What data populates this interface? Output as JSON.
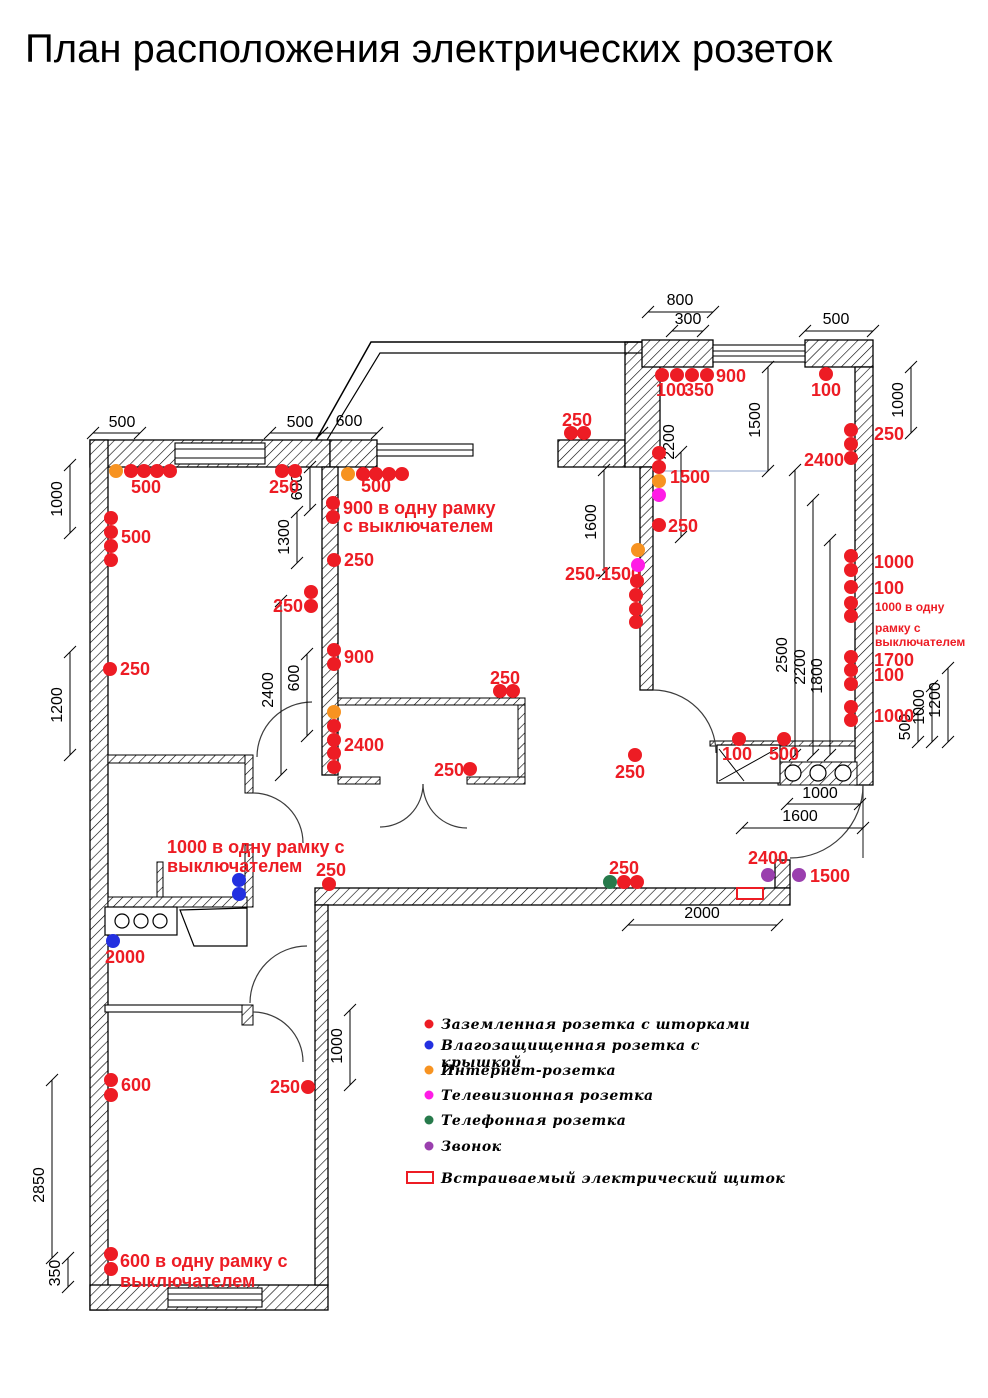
{
  "title": "План расположения электрических розеток",
  "colors": {
    "r": "#ed1c24",
    "b": "#2330e0",
    "o": "#f79321",
    "m": "#ff1ce6",
    "g": "#277a4b",
    "p": "#9a3fae",
    "label": "#ed1c24",
    "dim": "#000000",
    "panel_outline": "#ed1c24"
  },
  "type_names": {
    "r": "grounded-socket",
    "b": "moisture-protected-socket",
    "o": "internet-socket",
    "m": "tv-socket",
    "g": "phone-socket",
    "p": "doorbell"
  },
  "outlets": [
    [
      116,
      471,
      "o"
    ],
    [
      131,
      471,
      "r"
    ],
    [
      144,
      471,
      "r"
    ],
    [
      157,
      471,
      "r"
    ],
    [
      170,
      471,
      "r"
    ],
    [
      111,
      518,
      "r"
    ],
    [
      111,
      532,
      "r"
    ],
    [
      111,
      546,
      "r"
    ],
    [
      111,
      560,
      "r"
    ],
    [
      110,
      669,
      "r"
    ],
    [
      282,
      471,
      "r"
    ],
    [
      295,
      471,
      "r"
    ],
    [
      311,
      592,
      "r"
    ],
    [
      311,
      606,
      "r"
    ],
    [
      334,
      650,
      "r"
    ],
    [
      334,
      664,
      "r"
    ],
    [
      334,
      712,
      "o"
    ],
    [
      334,
      726,
      "r"
    ],
    [
      334,
      740,
      "r"
    ],
    [
      334,
      753,
      "r"
    ],
    [
      334,
      767,
      "r"
    ],
    [
      348,
      474,
      "o"
    ],
    [
      363,
      474,
      "r"
    ],
    [
      376,
      474,
      "r"
    ],
    [
      389,
      474,
      "r"
    ],
    [
      402,
      474,
      "r"
    ],
    [
      333,
      503,
      "r"
    ],
    [
      333,
      517,
      "r"
    ],
    [
      334,
      560,
      "r"
    ],
    [
      571,
      433,
      "r"
    ],
    [
      584,
      433,
      "r"
    ],
    [
      638,
      550,
      "o"
    ],
    [
      638,
      565,
      "m"
    ],
    [
      637,
      581,
      "r"
    ],
    [
      636,
      595,
      "r"
    ],
    [
      636,
      609,
      "r"
    ],
    [
      636,
      622,
      "r"
    ],
    [
      659,
      453,
      "r"
    ],
    [
      659,
      467,
      "r"
    ],
    [
      659,
      481,
      "o"
    ],
    [
      659,
      495,
      "m"
    ],
    [
      659,
      525,
      "r"
    ],
    [
      662,
      375,
      "r"
    ],
    [
      677,
      375,
      "r"
    ],
    [
      692,
      375,
      "r"
    ],
    [
      707,
      375,
      "r"
    ],
    [
      826,
      374,
      "r"
    ],
    [
      851,
      430,
      "r"
    ],
    [
      851,
      444,
      "r"
    ],
    [
      851,
      458,
      "r"
    ],
    [
      851,
      556,
      "r"
    ],
    [
      851,
      570,
      "r"
    ],
    [
      851,
      587,
      "r"
    ],
    [
      851,
      603,
      "r"
    ],
    [
      851,
      616,
      "r"
    ],
    [
      851,
      657,
      "r"
    ],
    [
      851,
      670,
      "r"
    ],
    [
      851,
      684,
      "r"
    ],
    [
      851,
      707,
      "r"
    ],
    [
      851,
      720,
      "r"
    ],
    [
      739,
      739,
      "r"
    ],
    [
      784,
      739,
      "r"
    ],
    [
      635,
      755,
      "r"
    ],
    [
      329,
      884,
      "r"
    ],
    [
      610,
      882,
      "g"
    ],
    [
      624,
      882,
      "r"
    ],
    [
      637,
      882,
      "r"
    ],
    [
      768,
      875,
      "p"
    ],
    [
      799,
      875,
      "p"
    ],
    [
      500,
      691,
      "r"
    ],
    [
      513,
      691,
      "r"
    ],
    [
      470,
      769,
      "r"
    ],
    [
      239,
      880,
      "b"
    ],
    [
      239,
      894,
      "b"
    ],
    [
      113,
      941,
      "b"
    ],
    [
      111,
      1080,
      "r"
    ],
    [
      111,
      1095,
      "r"
    ],
    [
      308,
      1087,
      "r"
    ],
    [
      111,
      1254,
      "r"
    ],
    [
      111,
      1269,
      "r"
    ]
  ],
  "plan_labels": [
    {
      "t": "500",
      "x": 146,
      "y": 493,
      "a": "middle"
    },
    {
      "t": "500",
      "x": 121,
      "y": 543,
      "a": "start"
    },
    {
      "t": "250",
      "x": 120,
      "y": 675,
      "a": "start"
    },
    {
      "t": "250",
      "x": 284,
      "y": 493,
      "a": "middle"
    },
    {
      "t": "250",
      "x": 303,
      "y": 612,
      "a": "end"
    },
    {
      "t": "900",
      "x": 344,
      "y": 663,
      "a": "start"
    },
    {
      "t": "2400",
      "x": 344,
      "y": 751,
      "a": "start"
    },
    {
      "t": "500",
      "x": 376,
      "y": 492,
      "a": "middle"
    },
    {
      "t": "900 в одну рамку",
      "x": 343,
      "y": 514,
      "a": "start"
    },
    {
      "t": "с выключателем",
      "x": 343,
      "y": 532,
      "a": "start"
    },
    {
      "t": "250",
      "x": 344,
      "y": 566,
      "a": "start"
    },
    {
      "t": "250",
      "x": 577,
      "y": 426,
      "a": "middle"
    },
    {
      "t": "250-1500",
      "x": 565,
      "y": 580,
      "a": "start"
    },
    {
      "t": "1500",
      "x": 670,
      "y": 483,
      "a": "start"
    },
    {
      "t": "250",
      "x": 668,
      "y": 532,
      "a": "start"
    },
    {
      "t": "900",
      "x": 716,
      "y": 382,
      "a": "start"
    },
    {
      "t": "100",
      "x": 656,
      "y": 396,
      "a": "start"
    },
    {
      "t": "350",
      "x": 684,
      "y": 396,
      "a": "start"
    },
    {
      "t": "100",
      "x": 826,
      "y": 396,
      "a": "middle"
    },
    {
      "t": "250",
      "x": 874,
      "y": 440,
      "a": "start"
    },
    {
      "t": "2400",
      "x": 844,
      "y": 466,
      "a": "end"
    },
    {
      "t": "1000",
      "x": 874,
      "y": 568,
      "a": "start"
    },
    {
      "t": "100",
      "x": 874,
      "y": 594,
      "a": "start"
    },
    {
      "t": "1000 в одну",
      "x": 875,
      "y": 611,
      "a": "start",
      "s": 12
    },
    {
      "t": "рамку с",
      "x": 875,
      "y": 632,
      "a": "start",
      "s": 12
    },
    {
      "t": "выключателем",
      "x": 875,
      "y": 646,
      "a": "start",
      "s": 12
    },
    {
      "t": "1700",
      "x": 874,
      "y": 666,
      "a": "start"
    },
    {
      "t": "100",
      "x": 874,
      "y": 681,
      "a": "start"
    },
    {
      "t": "1000",
      "x": 874,
      "y": 722,
      "a": "start"
    },
    {
      "t": "100",
      "x": 737,
      "y": 760,
      "a": "middle"
    },
    {
      "t": "500",
      "x": 784,
      "y": 760,
      "a": "middle"
    },
    {
      "t": "250",
      "x": 630,
      "y": 778,
      "a": "middle"
    },
    {
      "t": "250",
      "x": 505,
      "y": 684,
      "a": "middle"
    },
    {
      "t": "250",
      "x": 464,
      "y": 776,
      "a": "end"
    },
    {
      "t": "250",
      "x": 331,
      "y": 876,
      "a": "middle"
    },
    {
      "t": "250",
      "x": 624,
      "y": 874,
      "a": "middle"
    },
    {
      "t": "2400",
      "x": 768,
      "y": 864,
      "a": "middle"
    },
    {
      "t": "1500",
      "x": 810,
      "y": 882,
      "a": "start"
    },
    {
      "t": "1000 в одну рамку с",
      "x": 167,
      "y": 853,
      "a": "start"
    },
    {
      "t": "выключателем",
      "x": 167,
      "y": 872,
      "a": "start"
    },
    {
      "t": "2000",
      "x": 105,
      "y": 963,
      "a": "start"
    },
    {
      "t": "600",
      "x": 121,
      "y": 1091,
      "a": "start"
    },
    {
      "t": "250",
      "x": 300,
      "y": 1093,
      "a": "end"
    },
    {
      "t": "600 в одну рамку с",
      "x": 120,
      "y": 1267,
      "a": "start"
    },
    {
      "t": "выключателем",
      "x": 120,
      "y": 1287,
      "a": "start"
    }
  ],
  "dimensions": [
    {
      "t": "500",
      "tx": 122,
      "ty": 427,
      "l": [
        93,
        433,
        140,
        433
      ]
    },
    {
      "t": "500",
      "tx": 300,
      "ty": 427,
      "l": [
        270,
        433,
        322,
        433
      ]
    },
    {
      "t": "600",
      "tx": 349,
      "ty": 426,
      "l": [
        322,
        433,
        377,
        433
      ]
    },
    {
      "t": "1000",
      "tx": 62,
      "ty": 499,
      "r": 1,
      "l": [
        70,
        465,
        70,
        533
      ]
    },
    {
      "t": "1200",
      "tx": 62,
      "ty": 705,
      "r": 1,
      "l": [
        70,
        652,
        70,
        755
      ]
    },
    {
      "t": "800",
      "tx": 680,
      "ty": 305,
      "l": [
        648,
        312,
        713,
        312
      ]
    },
    {
      "t": "300",
      "tx": 688,
      "ty": 324,
      "l": [
        672,
        331,
        703,
        331
      ]
    },
    {
      "t": "500",
      "tx": 836,
      "ty": 324,
      "l": [
        805,
        331,
        873,
        331
      ]
    },
    {
      "t": "1500",
      "tx": 760,
      "ty": 420,
      "r": 1,
      "l": [
        768,
        367,
        768,
        471
      ]
    },
    {
      "t": "2200",
      "tx": 674,
      "ty": 442,
      "r": 1,
      "l": [
        681,
        452,
        681,
        537
      ]
    },
    {
      "t": "1600",
      "tx": 596,
      "ty": 522,
      "r": 1,
      "l": [
        604,
        470,
        604,
        573
      ]
    },
    {
      "t": "1000",
      "tx": 903,
      "ty": 400,
      "r": 1,
      "l": [
        911,
        367,
        911,
        433
      ]
    },
    {
      "t": "600",
      "tx": 302,
      "ty": 487,
      "r": 1,
      "l": [
        310,
        467,
        310,
        510
      ]
    },
    {
      "t": "1300",
      "tx": 289,
      "ty": 537,
      "r": 1,
      "l": [
        297,
        512,
        297,
        563
      ]
    },
    {
      "t": "2400",
      "tx": 273,
      "ty": 690,
      "r": 1,
      "l": [
        281,
        601,
        281,
        775
      ]
    },
    {
      "t": "600",
      "tx": 299,
      "ty": 678,
      "r": 1,
      "l": [
        307,
        654,
        307,
        736
      ]
    },
    {
      "t": "2500",
      "tx": 787,
      "ty": 655,
      "r": 1,
      "l": [
        795,
        470,
        795,
        755
      ]
    },
    {
      "t": "2200",
      "tx": 805,
      "ty": 667,
      "r": 1,
      "l": [
        813,
        500,
        813,
        755
      ]
    },
    {
      "t": "1800",
      "tx": 822,
      "ty": 676,
      "r": 1,
      "l": [
        830,
        540,
        830,
        755
      ]
    },
    {
      "t": "1200",
      "tx": 940,
      "ty": 700,
      "r": 1,
      "l": [
        948,
        668,
        948,
        742
      ]
    },
    {
      "t": "1000",
      "tx": 924,
      "ty": 707,
      "r": 1,
      "l": [
        932,
        686,
        932,
        742
      ]
    },
    {
      "t": "500",
      "tx": 910,
      "ty": 727,
      "r": 1,
      "l": [
        918,
        712,
        918,
        742
      ]
    },
    {
      "t": "1000",
      "tx": 820,
      "ty": 798,
      "l": [
        787,
        804,
        860,
        804
      ]
    },
    {
      "t": "1600",
      "tx": 800,
      "ty": 821,
      "l": [
        742,
        828,
        863,
        828
      ]
    },
    {
      "t": "2000",
      "tx": 702,
      "ty": 918,
      "l": [
        628,
        925,
        777,
        925
      ]
    },
    {
      "t": "1000",
      "tx": 342,
      "ty": 1046,
      "r": 1,
      "l": [
        350,
        1010,
        350,
        1085
      ]
    },
    {
      "t": "2850",
      "tx": 44,
      "ty": 1185,
      "r": 1,
      "l": [
        52,
        1080,
        52,
        1258
      ]
    },
    {
      "t": "350",
      "tx": 60,
      "ty": 1273,
      "r": 1,
      "l": [
        68,
        1258,
        68,
        1287
      ]
    }
  ],
  "legend": {
    "items": [
      {
        "type": "r",
        "y": 1024,
        "label": "Заземленная розетка с шторками"
      },
      {
        "type": "b",
        "y": 1045,
        "label": "Влагозащищенная розетка с",
        "label2": "крышкой"
      },
      {
        "type": "o",
        "y": 1070,
        "label": "Интернет-розетка"
      },
      {
        "type": "m",
        "y": 1095,
        "label": "Телевизионная розетка"
      },
      {
        "type": "g",
        "y": 1120,
        "label": "Телефонная розетка"
      },
      {
        "type": "p",
        "y": 1146,
        "label": "Звонок"
      }
    ],
    "panel": {
      "y": 1178,
      "label": "Встраиваемый электрический щиток"
    }
  }
}
